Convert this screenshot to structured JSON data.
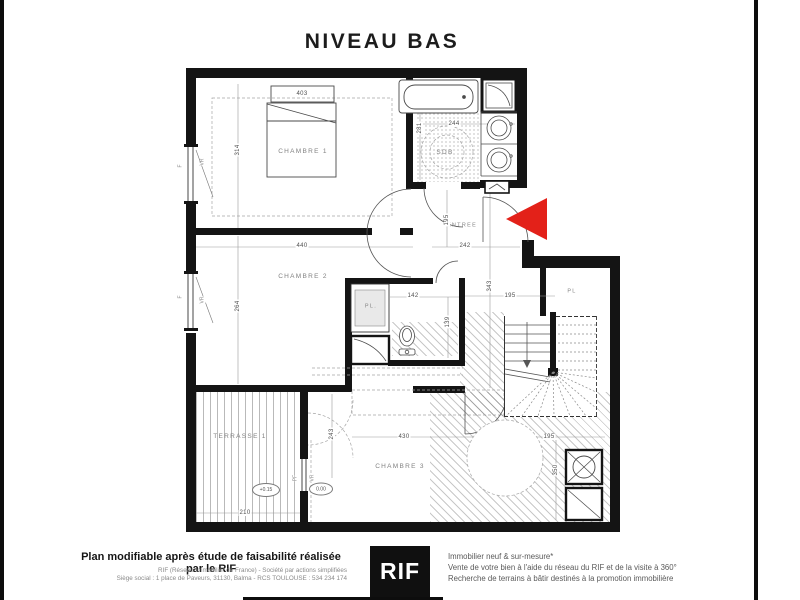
{
  "title": "NIVEAU BAS",
  "colors": {
    "wall": "#141414",
    "arrow_red": "#e32119"
  },
  "rooms": {
    "chambre1": "CHAMBRE 1",
    "chambre2": "CHAMBRE 2",
    "chambre3": "CHAMBRE 3",
    "sdb": "SDB",
    "entree": "ENTREE",
    "terrasse": "TERRASSE 1",
    "placard_hall": "PL",
    "placard_wc": "PL."
  },
  "dims": {
    "bed_width": "403",
    "c1_depth": "314",
    "c1_width": "440",
    "c2_depth": "264",
    "sdb_width": "244",
    "sdb_depth": "281",
    "entree_width": "242",
    "entree_depth": "195",
    "hall_depth": "343",
    "wc_width": "142",
    "wc_depth": "139",
    "stair_width": "195",
    "c3_width": "430",
    "c3_door_depth": "243",
    "laundry_width": "195",
    "laundry_depth": "350",
    "terrasse_width": "210"
  },
  "levels": {
    "terrasse": "+0.15",
    "chambre3": "0.00"
  },
  "windows": {
    "w1_type": "F",
    "w1_shutter": "VR",
    "w2_type": "F",
    "w2_shutter": "VR",
    "w3_type": "PF",
    "w3_shutter": "VR"
  },
  "footer": {
    "disclaimer_bold": "Plan modifiable après étude de faisabilité réalisée par le RIF",
    "company_line": "RIF (Réseau Immobilier de France) - Société par actions simplifiées",
    "address_line": "Siège social : 1 place de Paveurs, 31130, Balma - RCS TOULOUSE : 534 234 174",
    "logo_text": "RIF",
    "services_line1": "Immobilier neuf & sur-mesure*",
    "services_line2": "Vente de votre bien à l'aide du réseau du RIF et de la visite à 360°",
    "services_line3": "Recherche de terrains à bâtir destinés à la promotion immobilière"
  }
}
